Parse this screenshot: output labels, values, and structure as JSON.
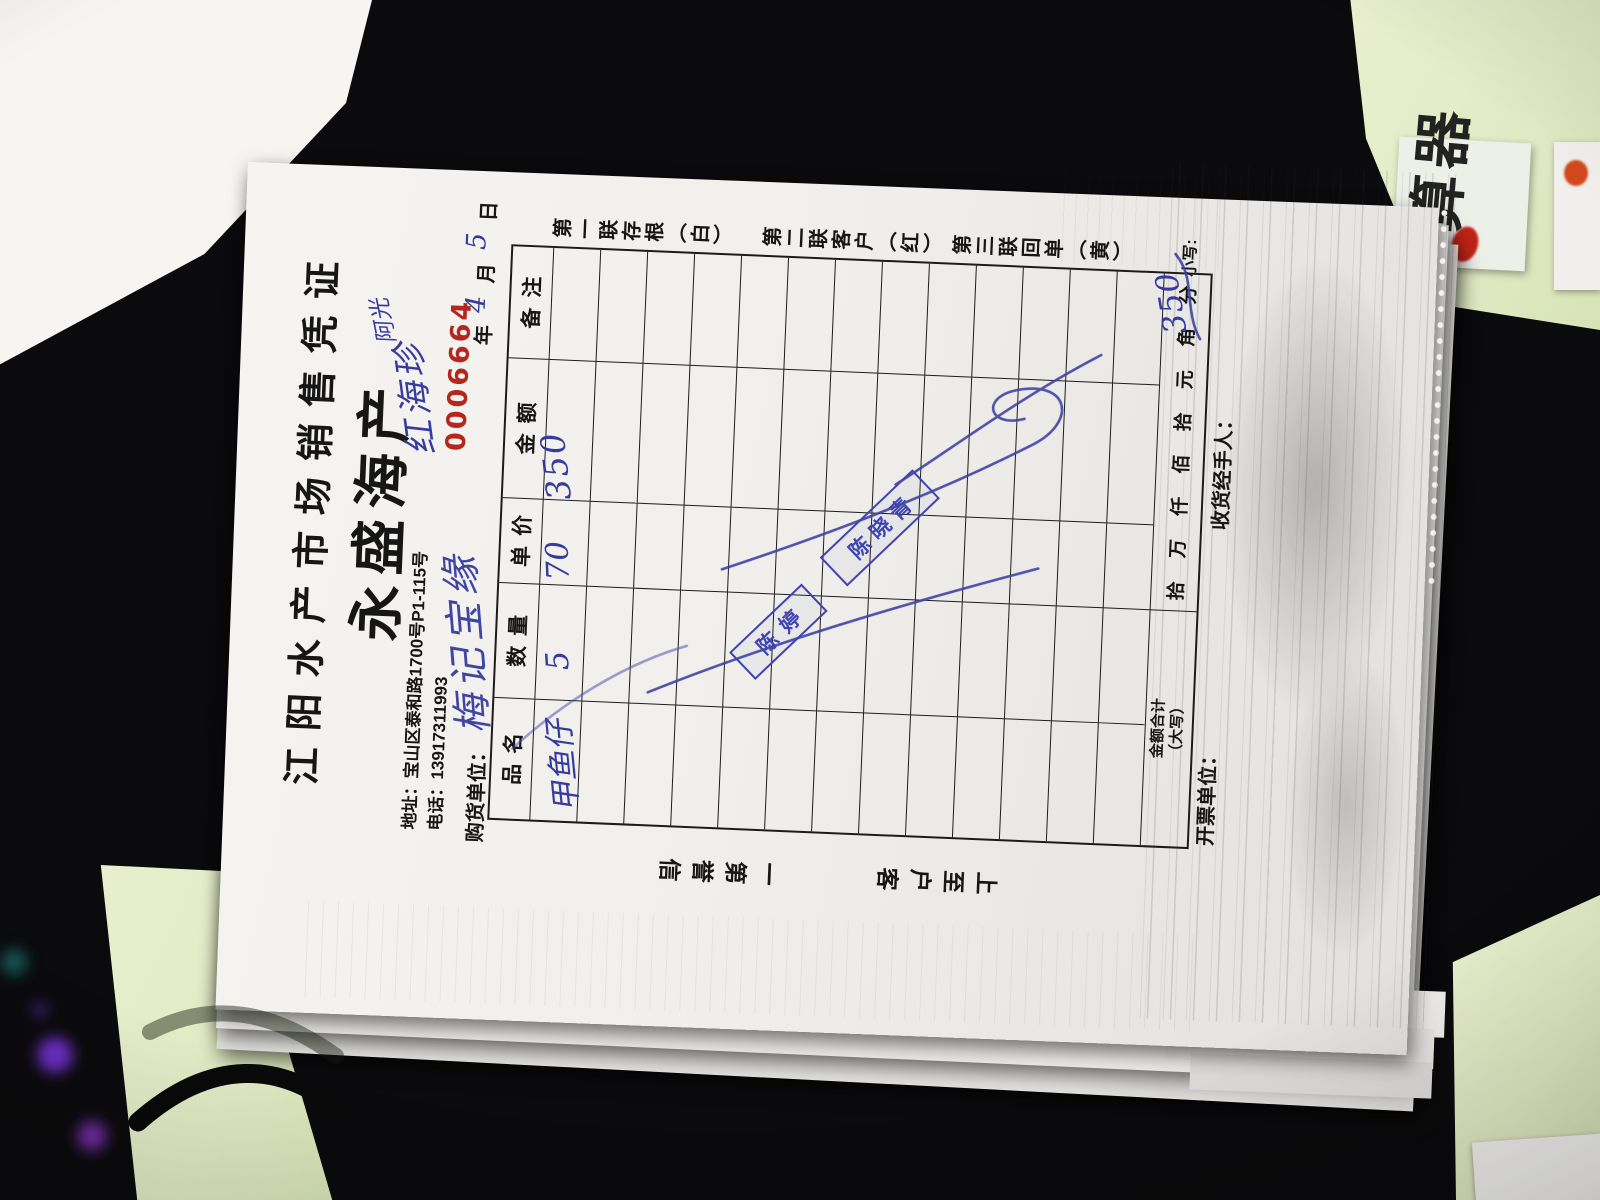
{
  "receipt": {
    "title": "江阳水产市场销售凭证",
    "brand": "永盛海产",
    "address_line": "地址：宝山区泰和路1700号P1-115号",
    "phone_line": "电话：13917311993",
    "serial": "0006664",
    "purchaser_label": "购货单位：",
    "date": {
      "year_label": "年",
      "month_label": "月",
      "day_label": "日",
      "month_value": "4",
      "day_value": "5"
    },
    "copies": [
      "第一联存根（白）",
      "第二联客户（红）",
      "第三联回单（黄）"
    ],
    "slogans": [
      "信誉第一",
      "客户至上"
    ],
    "table": {
      "headers": [
        "品名",
        "数量",
        "单价",
        "金额",
        "备注"
      ],
      "data_row_count": 13,
      "row1": {
        "product": "甲鱼仔",
        "qty": "5",
        "price": "70",
        "amount": "350"
      }
    },
    "total_row": {
      "label_line1": "金额合计",
      "label_line2": "（大写）",
      "units": "拾 万 仟 佰 拾 元 角 分",
      "small_label": "小写:",
      "small_value": "350"
    },
    "footer": {
      "issuer_label": "开票单位：",
      "receiver_label": "收货经手人："
    },
    "handwriting": {
      "annotation_small": "阿光",
      "annotation_name": "红海珍",
      "purchaser": "梅记宝缘"
    },
    "stamps": [
      "陈婷",
      "陈晓青"
    ],
    "colors": {
      "ink_blue": "#353c9e",
      "stamp_blue": "#3e45b2",
      "serial_red": "#b5271d",
      "paper": "#f1efeb",
      "table_green": "#e1eac4",
      "mat_black": "#0b0b0d"
    }
  },
  "scene": {
    "calculator_text": "算器"
  }
}
